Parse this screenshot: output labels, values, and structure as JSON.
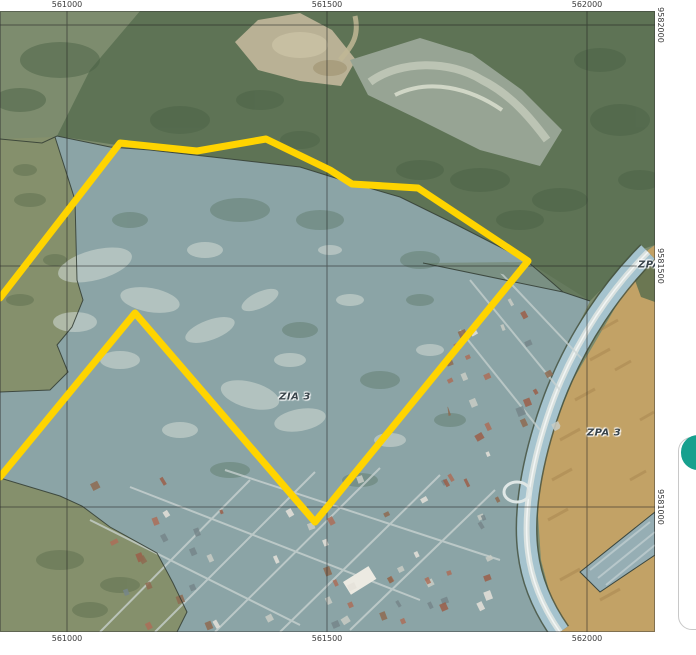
{
  "map": {
    "axis": {
      "x": [
        "561000",
        "561500",
        "562000"
      ],
      "y": [
        "9582000",
        "9581500",
        "9581000"
      ]
    },
    "labels": {
      "zia3": "ZIA 3",
      "zpa3": "ZPA 3",
      "zpa3_edge": "ZPA 3"
    },
    "colors": {
      "boundary_yellow": "#FFD400",
      "zia_zone_fill": "#8BA4A6",
      "zpa_zone_fill": "#C2A266",
      "forest_green": "#5E7355",
      "olive_land": "#85906C",
      "coastal_band": "#A5C3CE",
      "grid_line": "#222222"
    }
  },
  "side_panel": {
    "button_color": "#17A08E"
  }
}
